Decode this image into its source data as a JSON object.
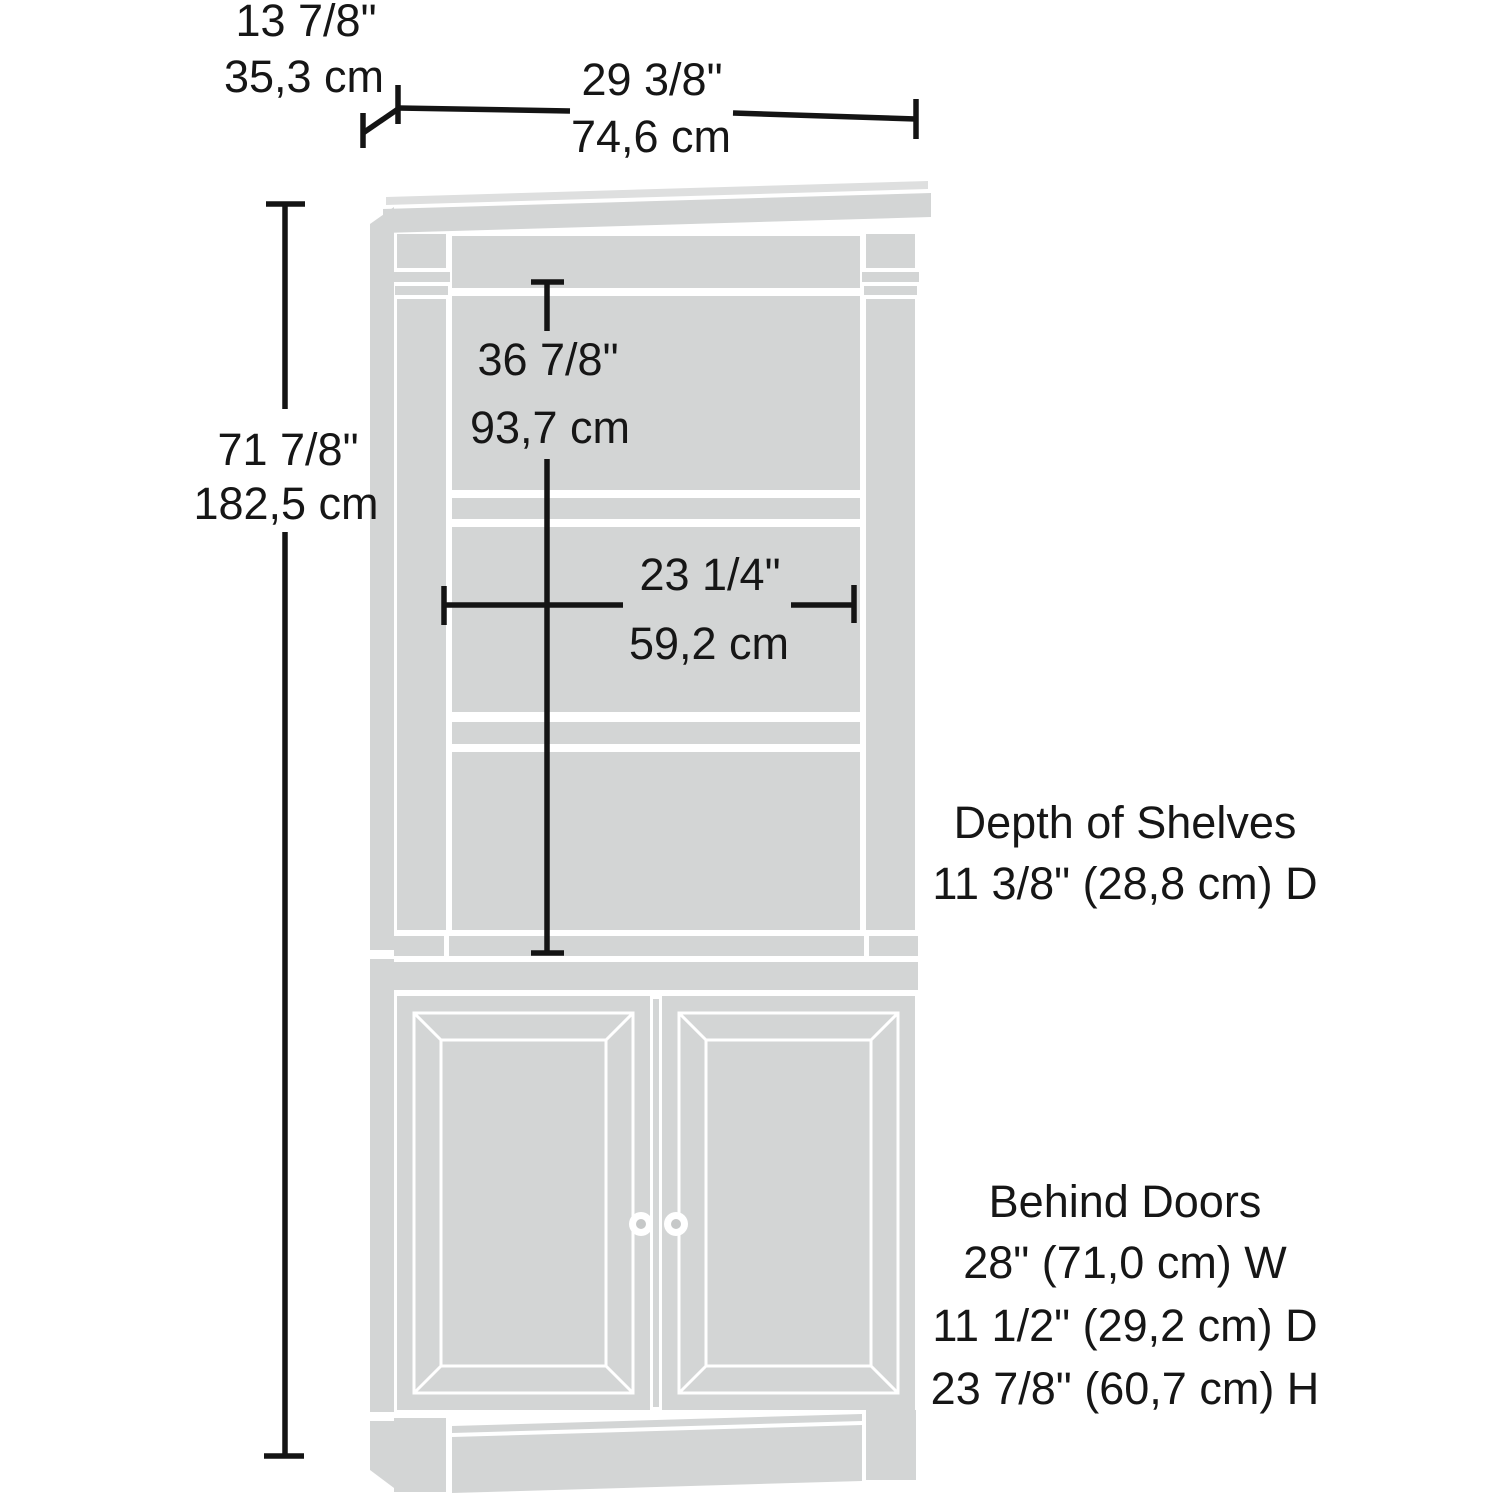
{
  "colors": {
    "background": "#ffffff",
    "furniture": "#d3d5d5",
    "furniture_light": "#dedfdf",
    "knob_dot": "#c6c8c8",
    "dimension_line": "#141414",
    "text": "#161616"
  },
  "dimensions": {
    "depth": {
      "inches": "13 7/8\"",
      "cm": "35,3 cm"
    },
    "width": {
      "inches": "29 3/8\"",
      "cm": "74,6 cm"
    },
    "height": {
      "inches": "71 7/8\"",
      "cm": "182,5 cm"
    },
    "interior_height": {
      "inches": "36 7/8\"",
      "cm": "93,7 cm"
    },
    "interior_width": {
      "inches": "23 1/4\"",
      "cm": "59,2 cm"
    }
  },
  "annotations": {
    "shelf_depth": {
      "line1": "Depth of Shelves",
      "line2": "11 3/8\" (28,8 cm) D"
    },
    "behind_doors": {
      "line1": "Behind Doors",
      "line2": "28\" (71,0 cm) W",
      "line3": "11 1/2\" (29,2 cm) D",
      "line4": "23 7/8\" (60,7 cm) H"
    }
  }
}
